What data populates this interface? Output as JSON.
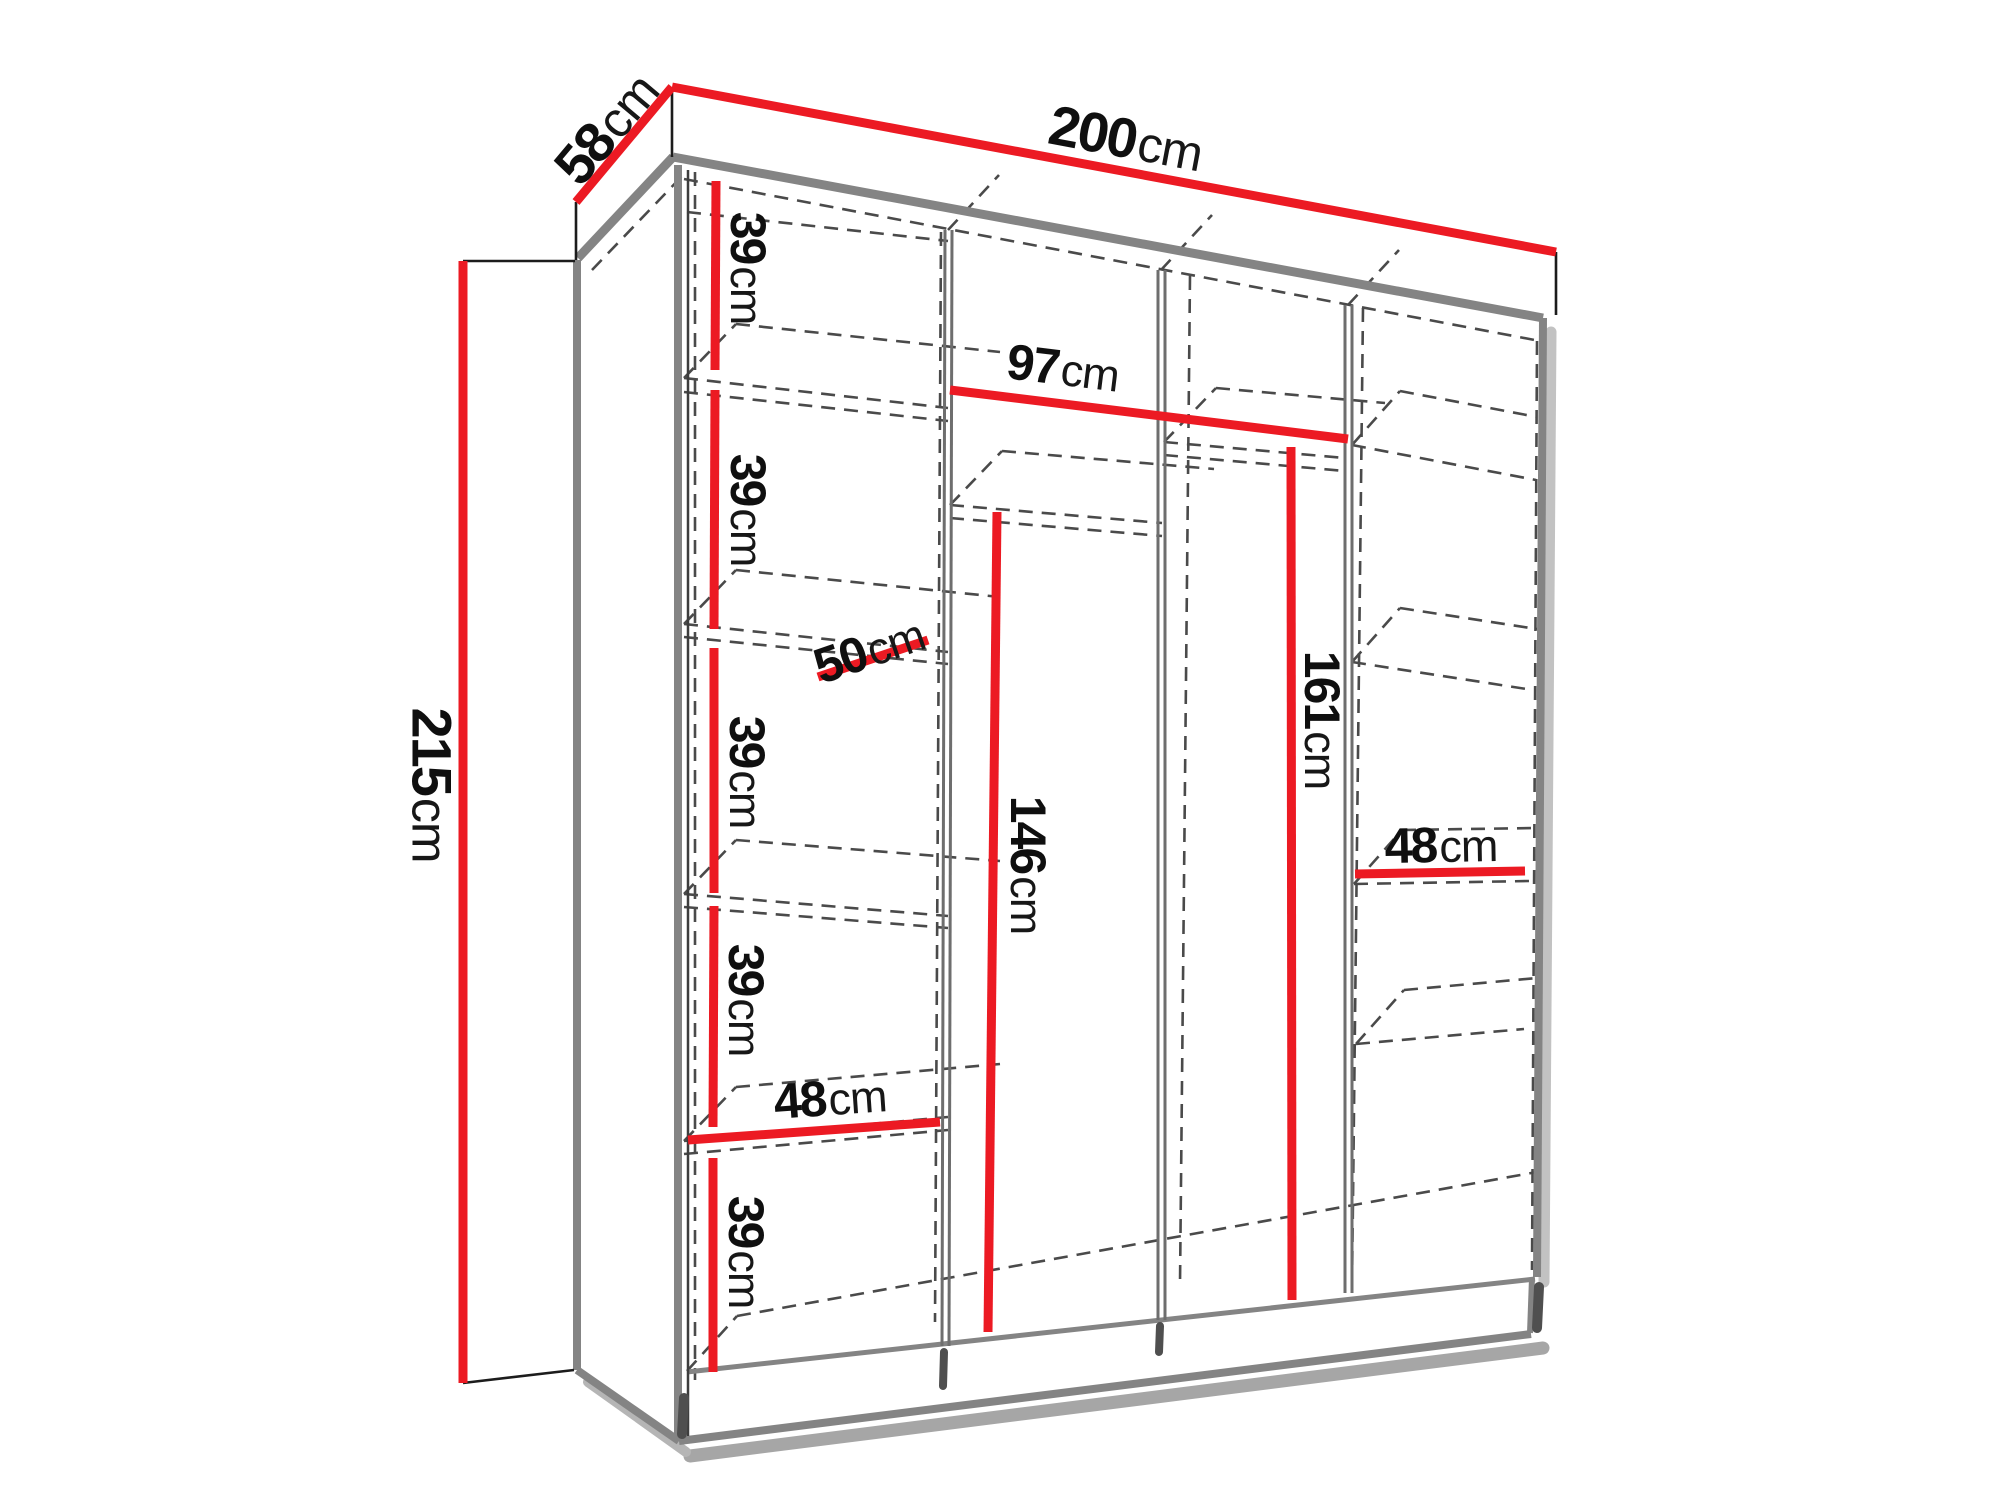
{
  "diagram": {
    "type": "furniture-dimension-diagram",
    "subject": "wardrobe line drawing with interior shelves and hanging sections",
    "background_color": "#ffffff",
    "dimension_color": "#ec1a23",
    "edge_color": "#848484",
    "dashed_color": "#4a4a4a",
    "label_text_color": "#0f0f0f",
    "labels": [
      {
        "id": "width-200",
        "value": "200",
        "unit": "cm"
      },
      {
        "id": "depth-58",
        "value": "58",
        "unit": "cm"
      },
      {
        "id": "height-215",
        "value": "215",
        "unit": "cm"
      },
      {
        "id": "opening-97",
        "value": "97",
        "unit": "cm"
      },
      {
        "id": "hang-161",
        "value": "161",
        "unit": "cm"
      },
      {
        "id": "hang-146",
        "value": "146",
        "unit": "cm"
      },
      {
        "id": "shelf-48-right",
        "value": "48",
        "unit": "cm"
      },
      {
        "id": "shelf-48-left",
        "value": "48",
        "unit": "cm"
      },
      {
        "id": "shelf-depth-50",
        "value": "50",
        "unit": "cm"
      },
      {
        "id": "gap-39-1",
        "value": "39",
        "unit": "cm"
      },
      {
        "id": "gap-39-2",
        "value": "39",
        "unit": "cm"
      },
      {
        "id": "gap-39-3",
        "value": "39",
        "unit": "cm"
      },
      {
        "id": "gap-39-4",
        "value": "39",
        "unit": "cm"
      },
      {
        "id": "gap-39-5",
        "value": "39",
        "unit": "cm"
      }
    ]
  }
}
